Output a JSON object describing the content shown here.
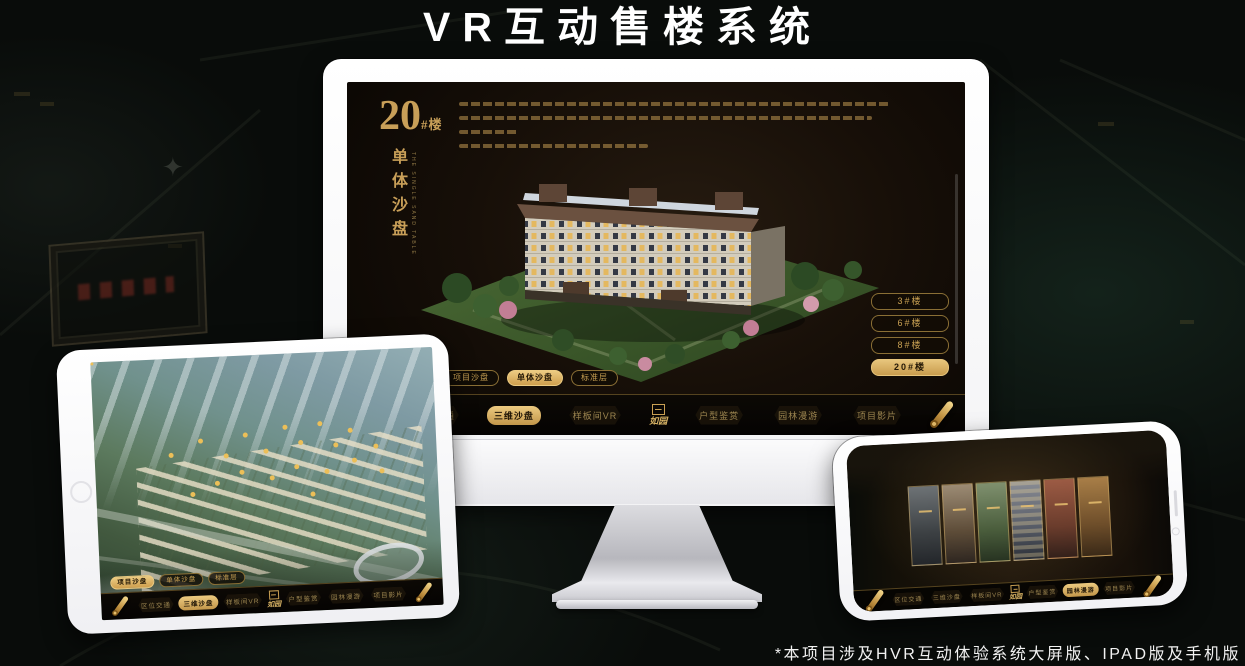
{
  "banner": {
    "title": "VR互动售楼系统"
  },
  "footnote": "*本项目涉及HVR互动体验系统大屏版、IPAD版及手机版",
  "colors": {
    "accent_gold": "#c89f58",
    "active_gold": "#e7c57c",
    "screen_bg": "#170f08",
    "banner_text": "#ffffff"
  },
  "monitor": {
    "heading": {
      "number": "20",
      "suffix": "#楼",
      "subtitle": "单体沙盘",
      "subtitle_en": "THE SINGLE SAND TABLE"
    },
    "floor_buttons": [
      {
        "label": "3#楼",
        "active": false
      },
      {
        "label": "6#楼",
        "active": false
      },
      {
        "label": "8#楼",
        "active": false
      },
      {
        "label": "20#楼",
        "active": true
      }
    ],
    "sub_tabs": [
      {
        "label": "项目沙盘",
        "active": false
      },
      {
        "label": "单体沙盘",
        "active": true
      },
      {
        "label": "标准层",
        "active": false
      }
    ],
    "nav": {
      "logo": "如园",
      "items": [
        {
          "label": "区位交通",
          "active": false
        },
        {
          "label": "三维沙盘",
          "active": true
        },
        {
          "label": "样板间VR",
          "active": false
        },
        {
          "label": "户型鉴赏",
          "active": false
        },
        {
          "label": "园林漫游",
          "active": false
        },
        {
          "label": "项目影片",
          "active": false
        }
      ]
    }
  },
  "tablet": {
    "sub_tabs": [
      {
        "label": "项目沙盘",
        "active": true
      },
      {
        "label": "单体沙盘",
        "active": false
      },
      {
        "label": "标准层",
        "active": false
      }
    ],
    "nav": {
      "logo": "如园",
      "items": [
        {
          "label": "区位交通",
          "active": false
        },
        {
          "label": "三维沙盘",
          "active": true
        },
        {
          "label": "样板间VR",
          "active": false
        },
        {
          "label": "户型鉴赏",
          "active": false
        },
        {
          "label": "园林漫游",
          "active": false
        },
        {
          "label": "项目影片",
          "active": false
        }
      ]
    }
  },
  "phone": {
    "nav": {
      "logo": "如园",
      "items": [
        {
          "label": "区位交通",
          "active": false
        },
        {
          "label": "三维沙盘",
          "active": false
        },
        {
          "label": "样板间VR",
          "active": false
        },
        {
          "label": "户型鉴赏",
          "active": false
        },
        {
          "label": "园林漫游",
          "active": true
        },
        {
          "label": "项目影片",
          "active": false
        }
      ]
    }
  }
}
